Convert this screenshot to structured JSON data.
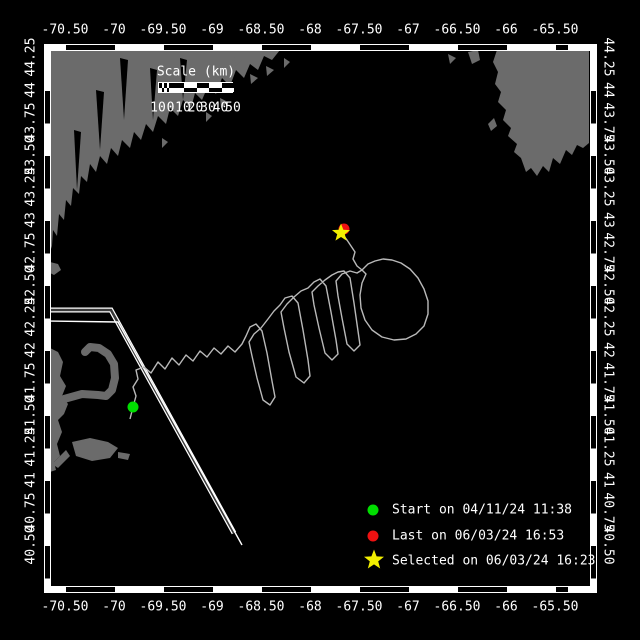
{
  "colors": {
    "bg": "#000000",
    "land": "#6b6b6b",
    "frame": "#ffffff",
    "text": "#ffffff",
    "track": "#b9b9b9",
    "lane-core": "#3a3a3a",
    "start": "#00dd00",
    "last": "#ee1111",
    "selected": "#f2ef00"
  },
  "axes": {
    "x": [
      {
        "label": "-70.50",
        "px": 65
      },
      {
        "label": "-70",
        "px": 114
      },
      {
        "label": "-69.50",
        "px": 163
      },
      {
        "label": "-69",
        "px": 212
      },
      {
        "label": "-68.50",
        "px": 261
      },
      {
        "label": "-68",
        "px": 310
      },
      {
        "label": "-67.50",
        "px": 359
      },
      {
        "label": "-67",
        "px": 408
      },
      {
        "label": "-66.50",
        "px": 457
      },
      {
        "label": "-66",
        "px": 506
      },
      {
        "label": "-65.50",
        "px": 555
      }
    ],
    "y": [
      {
        "label": "44.25",
        "py": 57
      },
      {
        "label": "44",
        "py": 90
      },
      {
        "label": "43.75",
        "py": 122
      },
      {
        "label": "43.50",
        "py": 155
      },
      {
        "label": "43.25",
        "py": 187
      },
      {
        "label": "43",
        "py": 220
      },
      {
        "label": "42.75",
        "py": 252
      },
      {
        "label": "42.50",
        "py": 285
      },
      {
        "label": "42.25",
        "py": 317
      },
      {
        "label": "42",
        "py": 350
      },
      {
        "label": "41.75",
        "py": 382
      },
      {
        "label": "41.50",
        "py": 415
      },
      {
        "label": "41.25",
        "py": 447
      },
      {
        "label": "41",
        "py": 480
      },
      {
        "label": "40.75",
        "py": 512
      },
      {
        "label": "40.50",
        "py": 545
      }
    ]
  },
  "scale_bar": {
    "title": "Scale (km)",
    "ticks": [
      {
        "label": "10",
        "px": 158
      },
      {
        "label": "0",
        "px": 170.5
      },
      {
        "label": "10",
        "px": 183
      },
      {
        "label": "20",
        "px": 195.5
      },
      {
        "label": "30",
        "px": 208
      },
      {
        "label": "40",
        "px": 220.5
      },
      {
        "label": "50",
        "px": 233
      }
    ]
  },
  "legend": {
    "items": [
      {
        "marker": "start-dot",
        "label": "Start on 04/11/24 11:38"
      },
      {
        "marker": "last-dot",
        "label": "Last on 06/03/24 16:53"
      },
      {
        "marker": "selected-star",
        "label": "Selected on 06/03/24 16:23"
      }
    ]
  },
  "markers": {
    "start": {
      "x": 133,
      "y": 407
    },
    "last": {
      "x": 344,
      "y": 229
    },
    "selected": {
      "x": 341,
      "y": 233
    }
  },
  "track": {
    "path": "M130,419 L133,407 L136,396 L133,387 L138,379 L136,370 L144,367 L151,373 L158,362 L165,369 L172,358 L179,365 L186,355 L193,361 L200,351 L207,357 L214,348 L221,354 L228,346 L235,352 L242,344 L246,336 L250,327 L256,324 L262,331 L267,353 L272,381 L275,397 L270,405 L263,400 L257,378 L252,356 L249,342 L254,334 L261,328 L268,319 L274,311 L280,305 L285,298 L292,296 L298,303 L303,330 L308,360 L310,376 L304,383 L296,377 L289,352 L284,328 L281,312 L287,304 L294,297 L301,291 L308,288 L314,282 L320,279 L326,286 L331,312 L336,340 L338,354 L332,360 L325,353 L319,328 L314,305 L312,292 L318,286 L325,280 L332,275 L338,272 L344,271 L350,278 L354,303 L358,331 L360,345 L354,351 L347,344 L342,318 L338,296 L336,281 L342,274 L350,271 L357,273 L362,270 L368,264 L375,261 L383,259 L392,260 L401,263 L410,269 L418,278 L424,289 L428,301 L428,314 L424,326 L416,334 L406,339 L394,340 L382,337 L372,330 L365,320 L361,308 L360,295 L362,283 L366,274 L362,270 L357,266 L353,259 L355,252 L351,246 L347,240 L344,236 L341,233"
  },
  "lanes": {
    "lane1": "M47,310 L111,310 L234,533",
    "lane2": "M47,321 L118,322 L242,545"
  }
}
